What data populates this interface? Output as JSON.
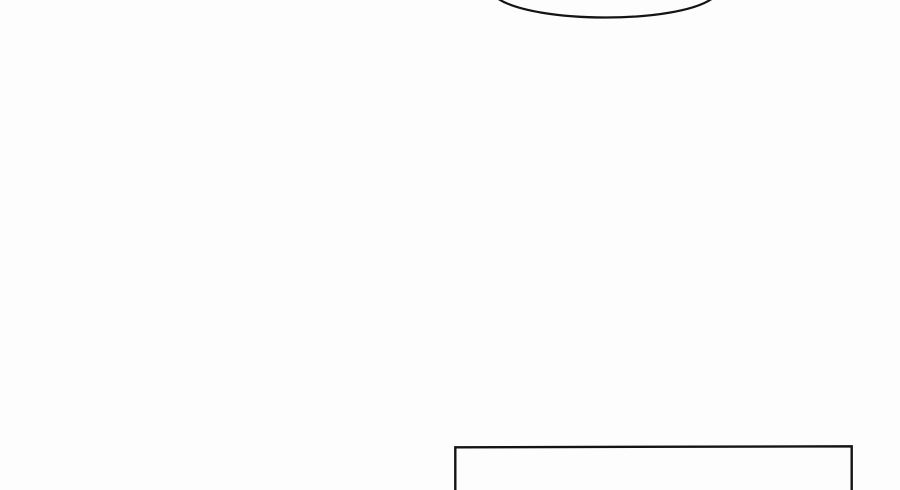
{
  "page": {
    "width": 900,
    "height": 490,
    "background_color": "#fdfdfd",
    "ink_color": "#141414",
    "description": "Nearly blank comic/manga page region: bottom arc of a speech balloon cropped by the top edge, and the top of a rectangular panel border cropped by the bottom edge."
  },
  "shapes": {
    "speech_bubble_arc": {
      "name": "speech-balloon-bottom-arc",
      "path": "M 497 -2 C 534 24 678 24 713 -2",
      "stroke_width": 2.2,
      "x_start": 498,
      "x_end": 712,
      "lowest_point_y": 17
    },
    "panel_border": {
      "name": "comic-panel-border-top",
      "path": "M 455.3 494 L 455.3 447.3 L 851.7 446.3 L 851.7 494",
      "stroke_width": 2.4,
      "left_x": 455,
      "right_x": 852,
      "top_y": 446
    }
  }
}
